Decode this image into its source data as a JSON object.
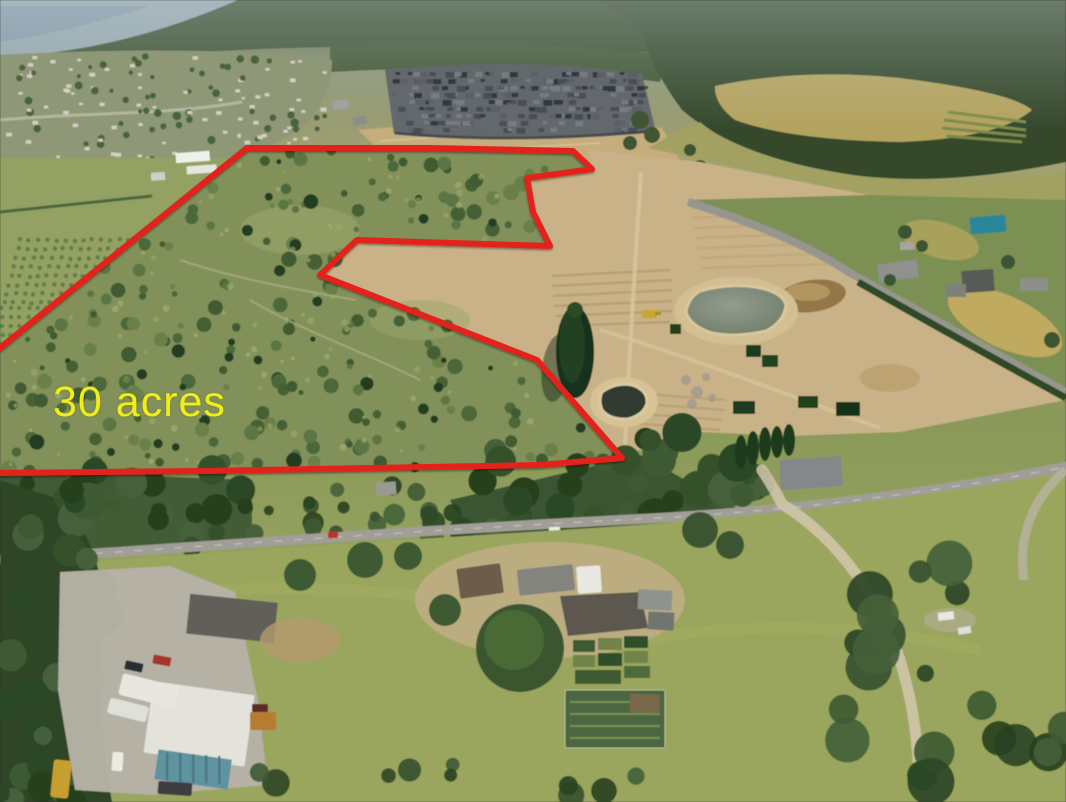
{
  "title": "Aerial photo of land with outlined parcel",
  "annotation": {
    "label": "30 acres",
    "color": "#f2ee15",
    "x": 53,
    "y": 381,
    "font_size": 43
  },
  "boundary": {
    "color": "#e3241c",
    "width": 6,
    "points": "0,348 247,148 430,148 573,151 592,169 527,178 533,212 550,246 357,240 320,275 537,360 622,458 540,465 200,471 0,473"
  },
  "palette": {
    "haze_blue": "#9aacb6",
    "forest_dark": "#35492c",
    "meadow_gold": "#b4a35f",
    "town_base": "#8e9877",
    "town_roof": "#d7d3c5",
    "subdivision_base": "#62686c",
    "subdivision_roofs": [
      "#484e54",
      "#767b7f",
      "#333941",
      "#5c6166"
    ],
    "field_green": "#93a163",
    "scrub_base": "#82915a",
    "scrub_trees": [
      "#4c683b",
      "#5b7544",
      "#456034",
      "#6b8049",
      "#3f5a33",
      "#223d20"
    ],
    "scrub_light": [
      "#9cab6b",
      "#a9b277"
    ],
    "forest_blobs": [
      "#2c4726",
      "#35512c",
      "#3e5a33",
      "#27411f",
      "#44603a"
    ],
    "dirt_base": "#c9b287",
    "dirt_strip": "#b49b71",
    "pond_large": "#7d897c",
    "pond_small": "#333b31",
    "road_gray": "#a09e96",
    "lawn_green": "#9aa65d",
    "gravel": "#b6b2a6",
    "bus_yellow": "#c79f2e",
    "excavator_yellow": "#c9a72e",
    "teal_roof": "#2c8799",
    "red_car": "#c03026"
  }
}
